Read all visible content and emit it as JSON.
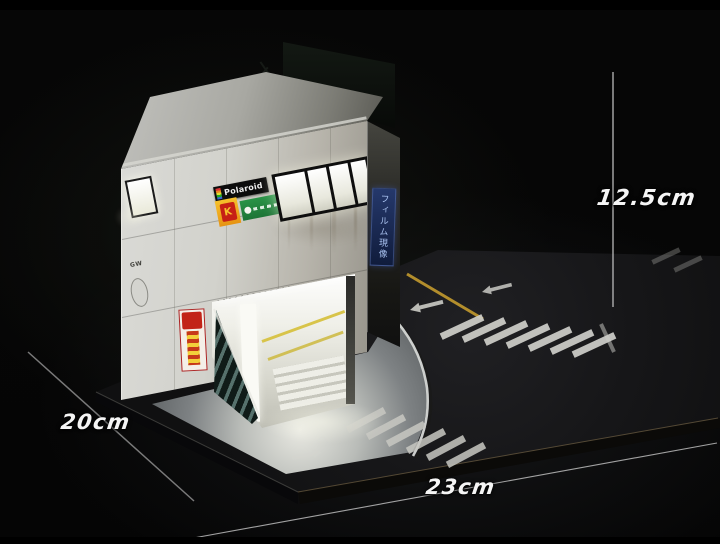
{
  "scene": {
    "subject": "Night diorama: miniature two-story photo shop building on a street-corner base",
    "background_color": "#050505"
  },
  "measurements": {
    "height_label": "12.5cm",
    "depth_label": "20cm",
    "width_label": "23cm"
  },
  "building": {
    "polaroid_sign": "Polaroid",
    "kodak_letter": "K",
    "film_banner_text": "フィルム現像",
    "wall_stencil": "GW"
  },
  "colors": {
    "dimension_text": "#f5f5f5",
    "road_center_line_yellow": "#c39a2e",
    "kodak_yellow": "#f6c12c",
    "kodak_red": "#c62015",
    "fuji_green": "#1e8a3c",
    "film_banner_blue": "#1b2a55",
    "stair_teal": "#56716c",
    "crosswalk_white": "#cfcfca"
  }
}
